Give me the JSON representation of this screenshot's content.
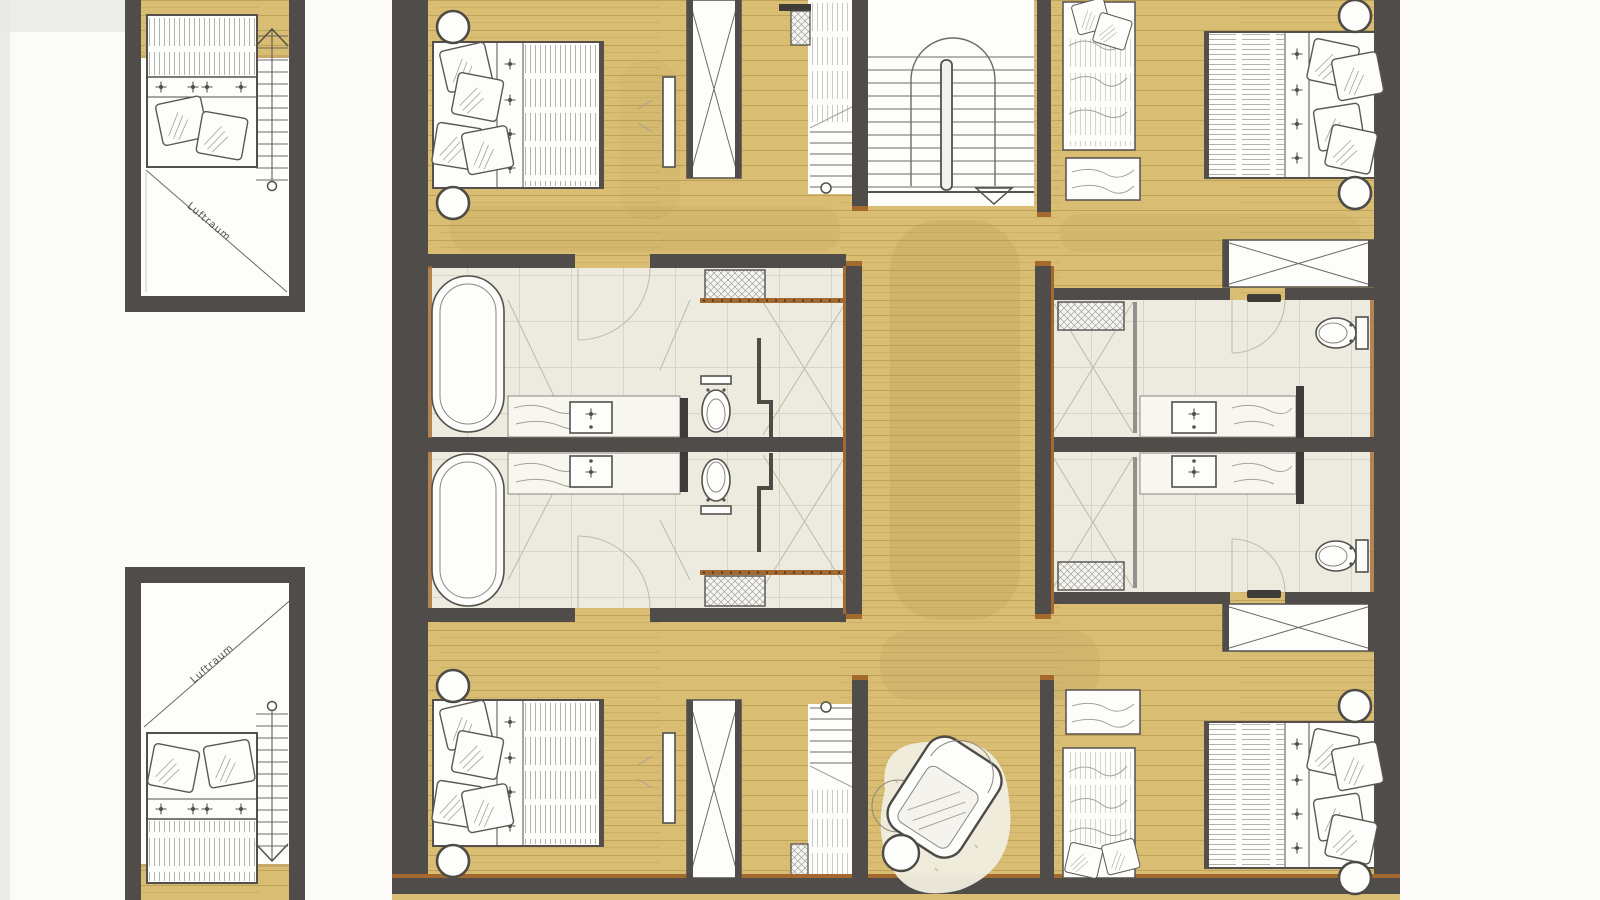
{
  "labels": {
    "luftraum_top": "Luftraum",
    "luftraum_bottom": "Luftraum"
  },
  "colors": {
    "paper": "#fbfbfa",
    "edge": "#e9e9e7",
    "wood": "#d8bd72",
    "woodline": "#9c7f3c",
    "wash": "#a88a46",
    "wall": "#4f4c49",
    "walldark": "#3e3c39",
    "trim": "#a4692f",
    "bath": "#edebdf",
    "tileline": "#cfccba",
    "ink": "#53504c",
    "inklight": "#8a8780",
    "sketch": "#a5a29a",
    "white": "#fdfdfb"
  }
}
